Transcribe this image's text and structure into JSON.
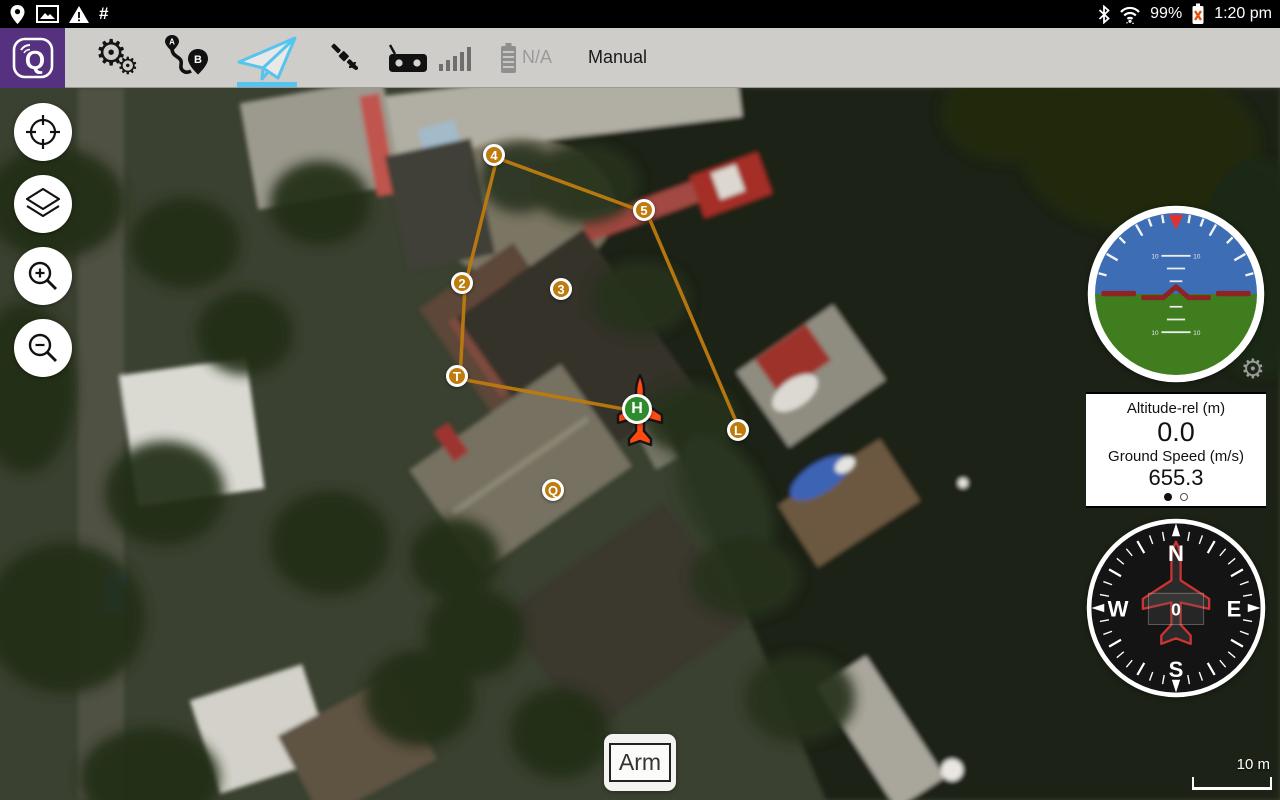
{
  "status_bar": {
    "time": "1:20 pm",
    "battery_percent": "99%",
    "hash": "#"
  },
  "toolbar": {
    "mode": "Manual",
    "battery_status": "N/A",
    "accent_color": "#55C4EE"
  },
  "map": {
    "scale_label": "10 m",
    "arm_button": "Arm",
    "waypoints": [
      {
        "label": "T",
        "x": 460,
        "y": 291
      },
      {
        "label": "2",
        "x": 465,
        "y": 198
      },
      {
        "label": "3",
        "x": 564,
        "y": 204
      },
      {
        "label": "4",
        "x": 497,
        "y": 70
      },
      {
        "label": "5",
        "x": 647,
        "y": 125
      },
      {
        "label": "L",
        "x": 741,
        "y": 345
      },
      {
        "label": "Q",
        "x": 556,
        "y": 405
      }
    ],
    "home": {
      "label": "H",
      "x": 640,
      "y": 324
    },
    "vehicle": {
      "x": 640,
      "y": 325,
      "heading_deg": 0
    },
    "path_segments": [
      [
        "H",
        "T"
      ],
      [
        "T",
        "2"
      ],
      [
        "2",
        "4"
      ],
      [
        "4",
        "5"
      ],
      [
        "5",
        "L"
      ]
    ],
    "colors": {
      "waypoint": "#BE7B0E",
      "path": "#BE7B0E",
      "home": "#2E8B2E",
      "vehicle": "#FF4A12"
    }
  },
  "instruments": {
    "altitude_label": "Altitude-rel (m)",
    "altitude_value": "0.0",
    "speed_label": "Ground Speed (m/s)",
    "speed_value": "655.3",
    "heading": "0",
    "compass": {
      "north": "N",
      "east": "E",
      "south": "S",
      "west": "W"
    }
  }
}
